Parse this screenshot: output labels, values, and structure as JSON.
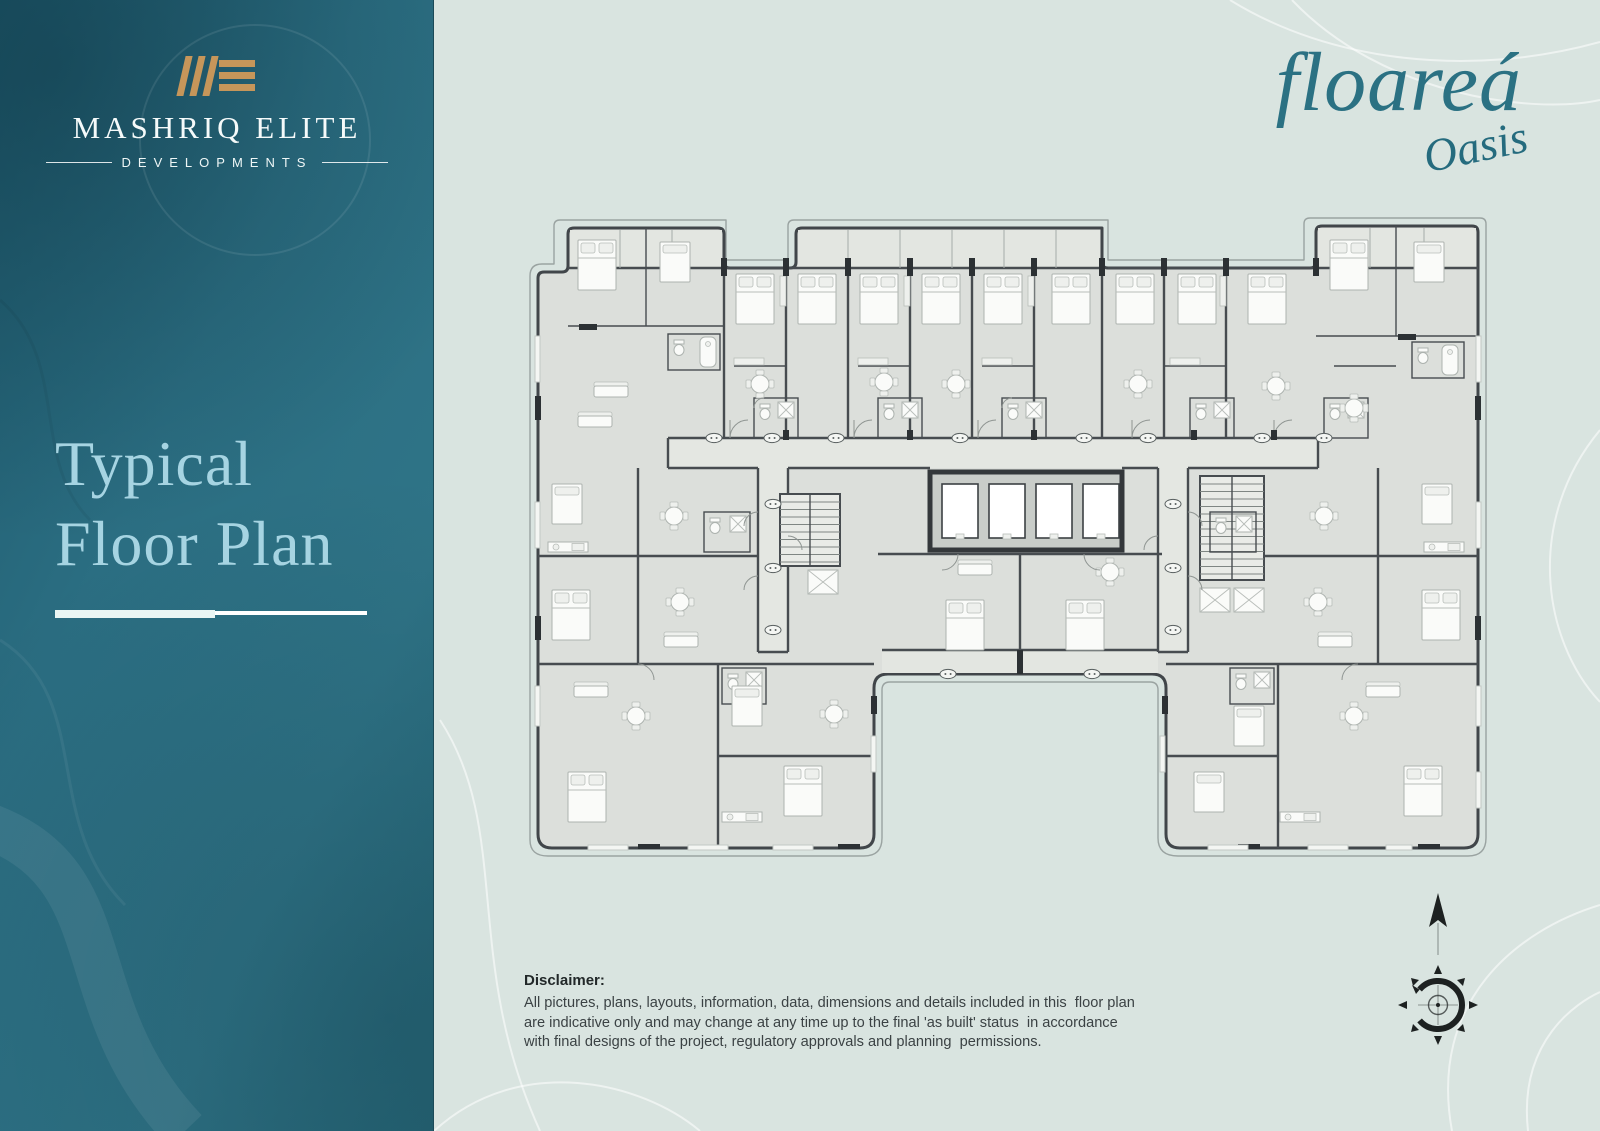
{
  "developer_logo": {
    "name": "MASHRIQ ELITE",
    "tagline": "DEVELOPMENTS",
    "monogram": "ME"
  },
  "page": {
    "title_line1": "Typical",
    "title_line2": "Floor Plan"
  },
  "project_logo": {
    "name": "floareá",
    "sub": "Oasis"
  },
  "floor_plan": {
    "kind": "residential typical floor plan drawing",
    "elevators_visible": 4,
    "stairwells_visible": 2
  },
  "disclaimer": {
    "heading": "Disclaimer:",
    "body": "All pictures, plans, layouts, information, data, dimensions and details included in this  floor plan\nare indicative only and may change at any time up to the final 'as built' status  in accordance\nwith final designs of the project, regulatory approvals and planning  permissions."
  },
  "colors": {
    "sidebar_teal": "#2e7286",
    "background_mint": "#d9e4e0",
    "logo_gold": "#c6965a",
    "title_blue": "#a6d4e2",
    "brand_teal": "#2b7183",
    "plan_wall": "#41464a",
    "plan_floor": "#dcdfdb",
    "compass_dark": "#1d2121"
  },
  "icons": {
    "monogram": "mashriq-elite-monogram-icon",
    "north_arrow": "north-arrow-icon",
    "compass": "compass-rose-icon"
  }
}
